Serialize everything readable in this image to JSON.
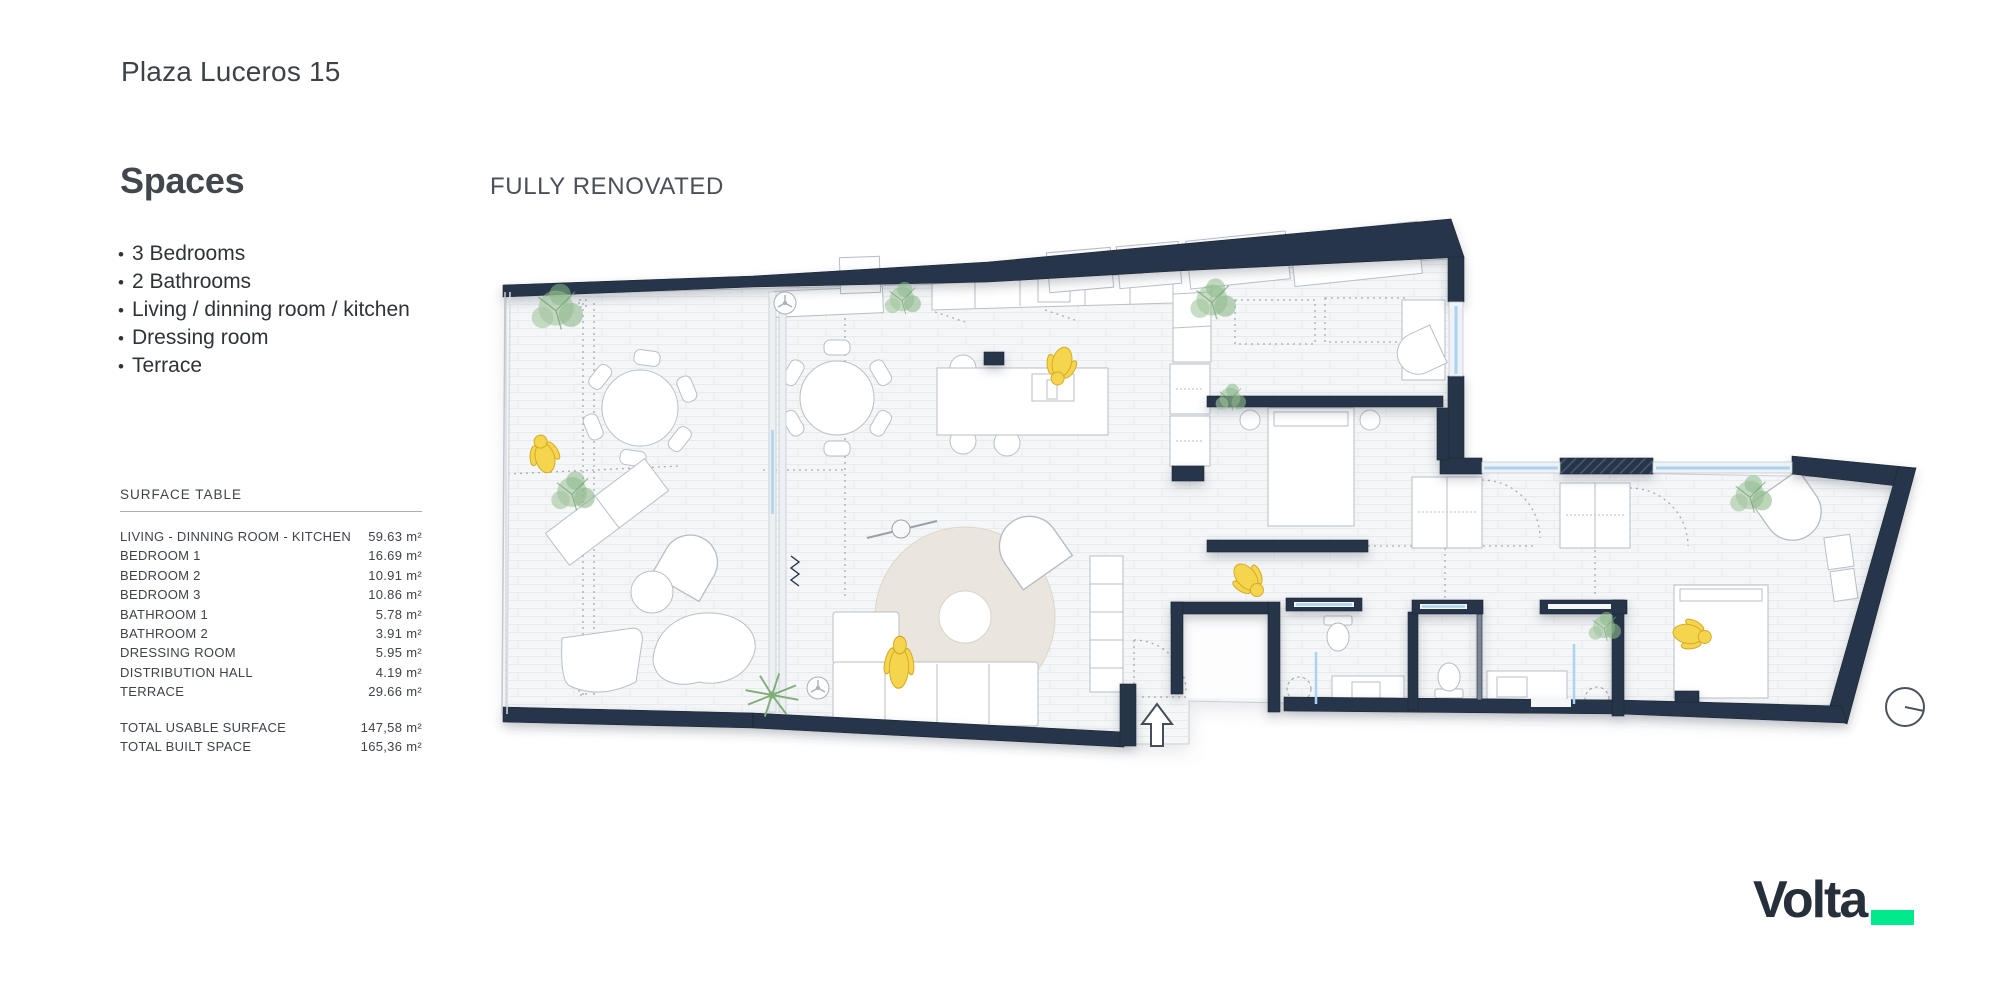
{
  "header": {
    "title": "Plaza Luceros 15"
  },
  "spaces": {
    "heading": "Spaces",
    "bullet_char": "•",
    "items": [
      {
        "text": "3 Bedrooms"
      },
      {
        "text": "2 Bathrooms"
      },
      {
        "text": "Living / dinning room  / kitchen"
      },
      {
        "text": "Dressing room"
      },
      {
        "text": "Terrace"
      }
    ]
  },
  "plan": {
    "banner": "FULLY RENOVATED",
    "icons": {
      "entrance_arrow": "up-arrow at main entrance",
      "north_indicator": "circle with pointer at lower right",
      "ceiling_fans": 2,
      "people_markers": 5,
      "plants": 8
    },
    "colors": {
      "wall": "#283549",
      "floor": "#f4f6f8",
      "floor_line": "#e8ebee",
      "rug": "#eae6de",
      "person": "#f5d44e",
      "plant": "#97bf93",
      "glass": "#a9d3ee"
    }
  },
  "surface_table": {
    "title": "SURFACE TABLE",
    "unit": "m²",
    "rows": [
      {
        "label": "LIVING - DINNING ROOM - KITCHEN",
        "value": "59.63"
      },
      {
        "label": "BEDROOM 1",
        "value": "16.69"
      },
      {
        "label": "BEDROOM 2",
        "value": "10.91"
      },
      {
        "label": "BEDROOM 3",
        "value": "10.86"
      },
      {
        "label": "BATHROOM 1",
        "value": "5.78"
      },
      {
        "label": "BATHROOM 2",
        "value": "3.91"
      },
      {
        "label": "DRESSING ROOM",
        "value": "5.95"
      },
      {
        "label": "DISTRIBUTION HALL",
        "value": "4.19"
      },
      {
        "label": "TERRACE",
        "value": "29.66"
      }
    ],
    "totals": [
      {
        "label": "TOTAL USABLE SURFACE",
        "value": "147,58"
      },
      {
        "label": "TOTAL BUILT SPACE",
        "value": "165,36"
      }
    ]
  },
  "logo": {
    "text": "Volta",
    "accent_color": "#00e98c"
  }
}
